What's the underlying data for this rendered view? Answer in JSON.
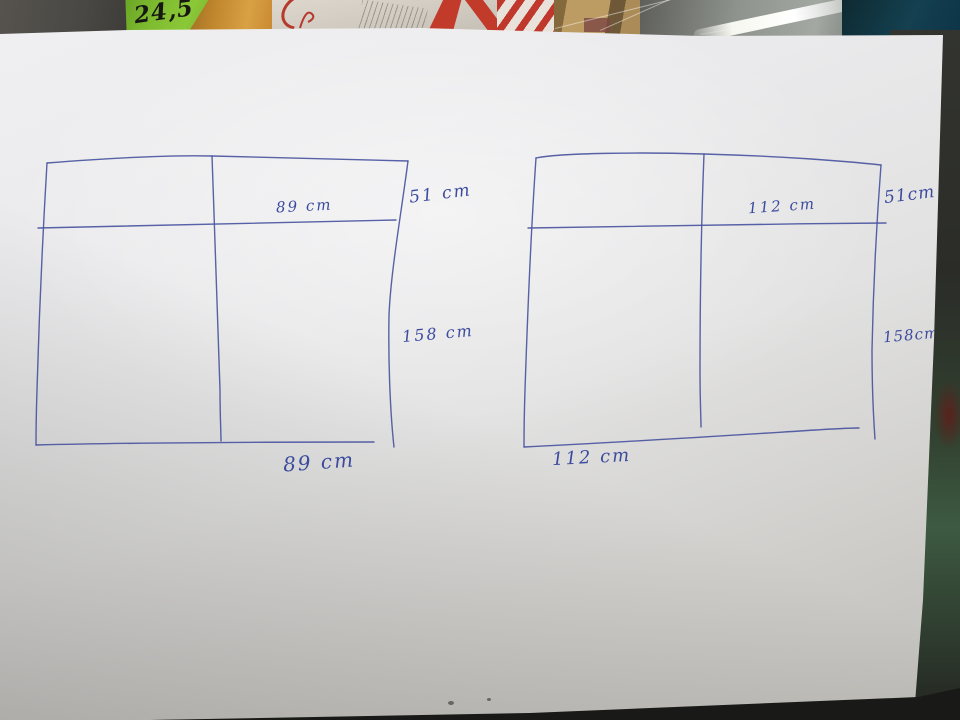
{
  "photo": {
    "price_tag": {
      "text": "24,5"
    },
    "sketch_left": {
      "top_width": "89 cm",
      "upper_right_height": "51 cm",
      "right_height": "158 cm",
      "bottom_width": "89 cm"
    },
    "sketch_right": {
      "top_width": "112 cm",
      "upper_right_height": "51cm",
      "right_height": "158cm",
      "bottom_width": "112 cm"
    },
    "colors": {
      "ink": "#4a55a0",
      "paper": "#e9e9eb",
      "price_tag_green": "#7fbb2f",
      "glass_teal": "#144050",
      "table_dark": "#191a17"
    }
  }
}
